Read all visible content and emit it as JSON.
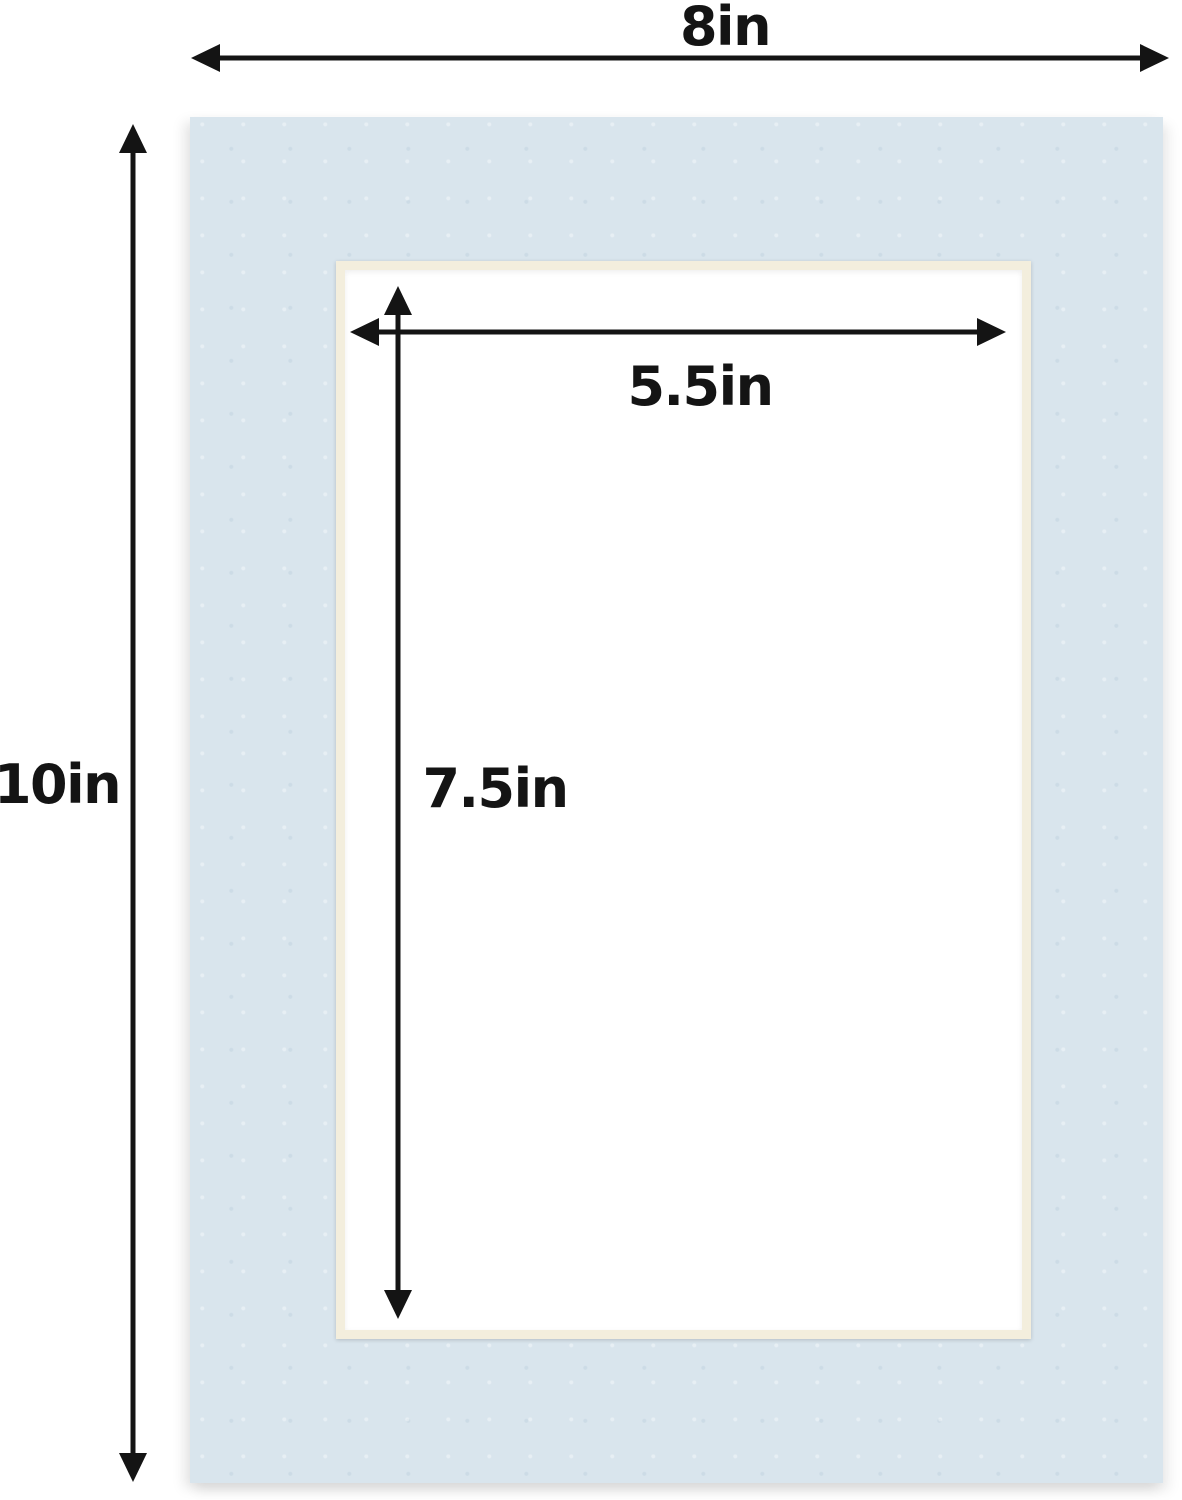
{
  "diagram": {
    "labels": {
      "outer_width": "8in",
      "outer_height": "10in",
      "opening_width": "5.5in",
      "opening_height": "7.5in"
    }
  },
  "colors": {
    "mat-blue": "#d9e5ed",
    "bevel-cream": "#f3eedd",
    "opening-white": "#ffffff",
    "arrow-black": "#141414",
    "page-bg": "#ffffff"
  }
}
